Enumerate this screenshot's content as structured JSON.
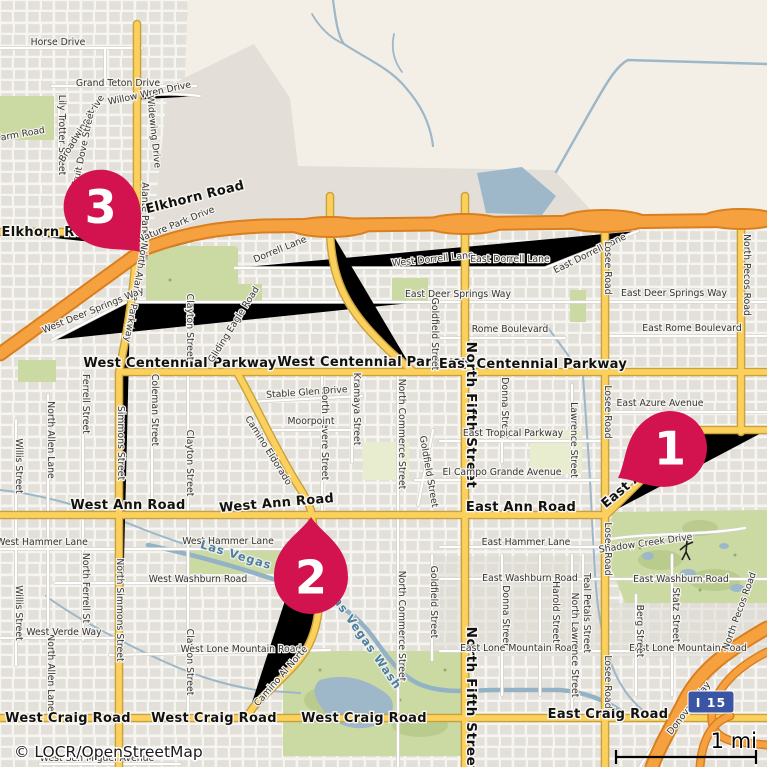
{
  "map": {
    "attribution": "© LOCR/OpenStreetMap",
    "scale": {
      "label": "1 mi"
    },
    "highway_shield": {
      "label": "I 15"
    },
    "colors": {
      "marker": "#d2134f",
      "road_major_fill": "#fbd05c",
      "road_major_casing": "#c8a13e",
      "motorway_fill": "#f6a13f",
      "motorway_casing": "#d97f1f",
      "water": "#9fb8c9",
      "park": "#cbd9a3",
      "desert": "#f3efe6",
      "hillshade": "#e3dfd8",
      "urban_block": "#e3e0d9",
      "shield_blue": "#3b55a5"
    },
    "markers": [
      {
        "number": "1",
        "tip_x": 618,
        "tip_y": 478,
        "rot": 60
      },
      {
        "number": "2",
        "tip_x": 311,
        "tip_y": 517,
        "rot": 180
      },
      {
        "number": "3",
        "tip_x": 140,
        "tip_y": 252,
        "rot": -41
      }
    ],
    "labels": [
      {
        "t": "Horse Drive",
        "x": 58,
        "y": 45,
        "r": 0,
        "c": "min"
      },
      {
        "t": "Grand Teton Drive",
        "x": 118,
        "y": 86,
        "r": 0,
        "c": "min"
      },
      {
        "t": "Willow Wren Drive",
        "x": 150,
        "y": 96,
        "r": -12,
        "c": "min"
      },
      {
        "t": "Lily Trotter Street",
        "x": 59,
        "y": 135,
        "r": 90,
        "c": "min"
      },
      {
        "t": "Broadwing Drive",
        "x": 84,
        "y": 130,
        "r": -58,
        "c": "min"
      },
      {
        "t": "Fruit Dove Street",
        "x": 86,
        "y": 149,
        "r": -78,
        "c": "min"
      },
      {
        "t": "Widewing Drive",
        "x": 151,
        "y": 132,
        "r": 84,
        "c": "min"
      },
      {
        "t": "Farm Road",
        "x": 21,
        "y": 137,
        "r": -10,
        "c": "min"
      },
      {
        "t": "Alante Parkway",
        "x": 142,
        "y": 218,
        "r": 90,
        "c": "min"
      },
      {
        "t": "Elkhorn Road",
        "x": 52,
        "y": 236,
        "r": 0,
        "c": "maj"
      },
      {
        "t": "Elkhorn Road",
        "x": 196,
        "y": 201,
        "r": -14,
        "c": "maj"
      },
      {
        "t": "Nature Park Drive",
        "x": 177,
        "y": 227,
        "r": -22,
        "c": "min"
      },
      {
        "t": "North Alante Parkway",
        "x": 133,
        "y": 292,
        "r": 100,
        "c": "min"
      },
      {
        "t": "West Deer Springs Way",
        "x": 94,
        "y": 313,
        "r": -22,
        "c": "min"
      },
      {
        "t": "East Deer Springs Way",
        "x": 458,
        "y": 297,
        "r": 0,
        "c": "min"
      },
      {
        "t": "East Deer Springs Way",
        "x": 674,
        "y": 296,
        "r": 0,
        "c": "min"
      },
      {
        "t": "Dorrell Lane",
        "x": 281,
        "y": 252,
        "r": -22,
        "c": "min"
      },
      {
        "t": "West Dorrell Lane",
        "x": 433,
        "y": 262,
        "r": -6,
        "c": "min"
      },
      {
        "t": "East Dorrell Lane",
        "x": 510,
        "y": 262,
        "r": 0,
        "c": "min"
      },
      {
        "t": "East Dorrell Lane",
        "x": 591,
        "y": 256,
        "r": -26,
        "c": "min"
      },
      {
        "t": "Rome Boulevard",
        "x": 510,
        "y": 332,
        "r": 0,
        "c": "min"
      },
      {
        "t": "East Rome Boulevard",
        "x": 692,
        "y": 331,
        "r": 0,
        "c": "min"
      },
      {
        "t": "West Centennial Parkway",
        "x": 180,
        "y": 367,
        "r": 0,
        "c": "maj"
      },
      {
        "t": "West Centennial Parkway",
        "x": 374,
        "y": 366,
        "r": 0,
        "c": "maj"
      },
      {
        "t": "East Centennial Parkway",
        "x": 533,
        "y": 368,
        "r": 0,
        "c": "maj"
      },
      {
        "t": "Clayton Street",
        "x": 187,
        "y": 327,
        "r": 90,
        "c": "min"
      },
      {
        "t": "Clayton Street",
        "x": 187,
        "y": 463,
        "r": 90,
        "c": "min"
      },
      {
        "t": "Clayton Street",
        "x": 187,
        "y": 662,
        "r": 90,
        "c": "min"
      },
      {
        "t": "Gliding Eagle Road",
        "x": 236,
        "y": 326,
        "r": -58,
        "c": "min"
      },
      {
        "t": "Goldfield Street",
        "x": 432,
        "y": 334,
        "r": 90,
        "c": "min"
      },
      {
        "t": "Goldfield Street",
        "x": 426,
        "y": 472,
        "r": 80,
        "c": "min"
      },
      {
        "t": "Goldfield Street",
        "x": 431,
        "y": 602,
        "r": 90,
        "c": "min"
      },
      {
        "t": "North Fifth Street",
        "x": 467,
        "y": 415,
        "r": 90,
        "c": "fifth"
      },
      {
        "t": "North Fifth Street",
        "x": 467,
        "y": 700,
        "r": 90,
        "c": "fifth"
      },
      {
        "t": "Donna Street",
        "x": 502,
        "y": 408,
        "r": 90,
        "c": "min"
      },
      {
        "t": "Donna Street",
        "x": 503,
        "y": 616,
        "r": 90,
        "c": "min"
      },
      {
        "t": "Kramaya Street",
        "x": 354,
        "y": 409,
        "r": 90,
        "c": "min"
      },
      {
        "t": "North Revere Street",
        "x": 322,
        "y": 434,
        "r": 90,
        "c": "min"
      },
      {
        "t": "North Commerce Street",
        "x": 399,
        "y": 434,
        "r": 90,
        "c": "min"
      },
      {
        "t": "North Commerce Street",
        "x": 399,
        "y": 626,
        "r": 90,
        "c": "min"
      },
      {
        "t": "Stable Glen Drive",
        "x": 307,
        "y": 395,
        "r": -4,
        "c": "min"
      },
      {
        "t": "Moorpoint",
        "x": 311,
        "y": 424,
        "r": 0,
        "c": "min"
      },
      {
        "t": "Camino Eldorado",
        "x": 266,
        "y": 452,
        "r": 58,
        "c": "min"
      },
      {
        "t": "East Tropical Parkway",
        "x": 513,
        "y": 436,
        "r": 0,
        "c": "min"
      },
      {
        "t": "El Campo Grande Avenue",
        "x": 502,
        "y": 475,
        "r": 0,
        "c": "min"
      },
      {
        "t": "Lawrence Street",
        "x": 571,
        "y": 440,
        "r": 90,
        "c": "min"
      },
      {
        "t": "East Azure Avenue",
        "x": 660,
        "y": 406,
        "r": 0,
        "c": "min"
      },
      {
        "t": "West Ann Road",
        "x": 128,
        "y": 509,
        "r": 0,
        "c": "maj"
      },
      {
        "t": "West Ann Road",
        "x": 277,
        "y": 507,
        "r": -5,
        "c": "maj"
      },
      {
        "t": "East Ann Road",
        "x": 521,
        "y": 511,
        "r": 0,
        "c": "maj"
      },
      {
        "t": "East Ann Road",
        "x": 648,
        "y": 473,
        "r": -40,
        "c": "maj"
      },
      {
        "t": "Simmons Street",
        "x": 118,
        "y": 443,
        "r": 90,
        "c": "min"
      },
      {
        "t": "North Simmons Street",
        "x": 117,
        "y": 610,
        "r": 90,
        "c": "min"
      },
      {
        "t": "Ferrell Street",
        "x": 83,
        "y": 404,
        "r": 90,
        "c": "min"
      },
      {
        "t": "North Ferrell St",
        "x": 83,
        "y": 588,
        "r": 90,
        "c": "min"
      },
      {
        "t": "Coleman Street",
        "x": 152,
        "y": 410,
        "r": 90,
        "c": "min"
      },
      {
        "t": "North Allen Lane",
        "x": 48,
        "y": 440,
        "r": 90,
        "c": "min"
      },
      {
        "t": "North Allen Lane",
        "x": 48,
        "y": 673,
        "r": 90,
        "c": "min"
      },
      {
        "t": "Willis Street",
        "x": 16,
        "y": 466,
        "r": 90,
        "c": "min"
      },
      {
        "t": "Willis Street",
        "x": 16,
        "y": 613,
        "r": 90,
        "c": "min"
      },
      {
        "t": "West Hammer Lane",
        "x": 42,
        "y": 545,
        "r": 0,
        "c": "min"
      },
      {
        "t": "West Hammer Lane",
        "x": 228,
        "y": 544,
        "r": 0,
        "c": "min"
      },
      {
        "t": "East Hammer Lane",
        "x": 526,
        "y": 545,
        "r": 0,
        "c": "min"
      },
      {
        "t": "West Washburn Road",
        "x": 198,
        "y": 582,
        "r": 0,
        "c": "min"
      },
      {
        "t": "East Washburn Road",
        "x": 530,
        "y": 581,
        "r": 0,
        "c": "min"
      },
      {
        "t": "East Washburn Road",
        "x": 681,
        "y": 582,
        "r": 0,
        "c": "min"
      },
      {
        "t": "West Verde Way",
        "x": 64,
        "y": 635,
        "r": 0,
        "c": "min"
      },
      {
        "t": "West Lone Mountain Road",
        "x": 241,
        "y": 652,
        "r": 0,
        "c": "min"
      },
      {
        "t": "East Lone Mountain Road",
        "x": 519,
        "y": 651,
        "r": 0,
        "c": "min"
      },
      {
        "t": "East Lone Mountain Road",
        "x": 688,
        "y": 651,
        "r": 0,
        "c": "min"
      },
      {
        "t": "Camino Al Norte",
        "x": 283,
        "y": 678,
        "r": -49,
        "c": "min"
      },
      {
        "t": "Harold Street",
        "x": 553,
        "y": 612,
        "r": 90,
        "c": "min"
      },
      {
        "t": "North Lawrence Street",
        "x": 572,
        "y": 645,
        "r": 90,
        "c": "min"
      },
      {
        "t": "Teal Petals Street",
        "x": 584,
        "y": 613,
        "r": 90,
        "c": "min"
      },
      {
        "t": "Statz Street",
        "x": 673,
        "y": 615,
        "r": 90,
        "c": "min"
      },
      {
        "t": "Berg Street",
        "x": 637,
        "y": 631,
        "r": 90,
        "c": "min"
      },
      {
        "t": "Donovan Way",
        "x": 691,
        "y": 710,
        "r": -52,
        "c": "min"
      },
      {
        "t": "West Craig Road",
        "x": 68,
        "y": 722,
        "r": 0,
        "c": "maj"
      },
      {
        "t": "West Craig Road",
        "x": 214,
        "y": 722,
        "r": 0,
        "c": "maj"
      },
      {
        "t": "West Craig Road",
        "x": 364,
        "y": 722,
        "r": 0,
        "c": "maj"
      },
      {
        "t": "East Craig Road",
        "x": 608,
        "y": 718,
        "r": 0,
        "c": "maj"
      },
      {
        "t": "Losee Road",
        "x": 605,
        "y": 268,
        "r": 90,
        "c": "min"
      },
      {
        "t": "Losee Road",
        "x": 605,
        "y": 412,
        "r": 90,
        "c": "min"
      },
      {
        "t": "Losee Road",
        "x": 605,
        "y": 549,
        "r": 90,
        "c": "min"
      },
      {
        "t": "Losee Road",
        "x": 605,
        "y": 682,
        "r": 90,
        "c": "min"
      },
      {
        "t": "North Pecos Road",
        "x": 744,
        "y": 275,
        "r": 90,
        "c": "min"
      },
      {
        "t": "North Pecos Road",
        "x": 742,
        "y": 612,
        "r": -70,
        "c": "min"
      },
      {
        "t": "Shadow Creek Drive",
        "x": 646,
        "y": 546,
        "r": -8,
        "c": "min"
      },
      {
        "t": "Las Vegas Wash",
        "x": 256,
        "y": 565,
        "r": 17,
        "c": "wat"
      },
      {
        "t": "Las Vegas Wash",
        "x": 362,
        "y": 642,
        "r": 55,
        "c": "wat"
      },
      {
        "t": "West San Miguel Avenue",
        "x": 97,
        "y": 761,
        "r": 0,
        "c": "min"
      }
    ]
  }
}
